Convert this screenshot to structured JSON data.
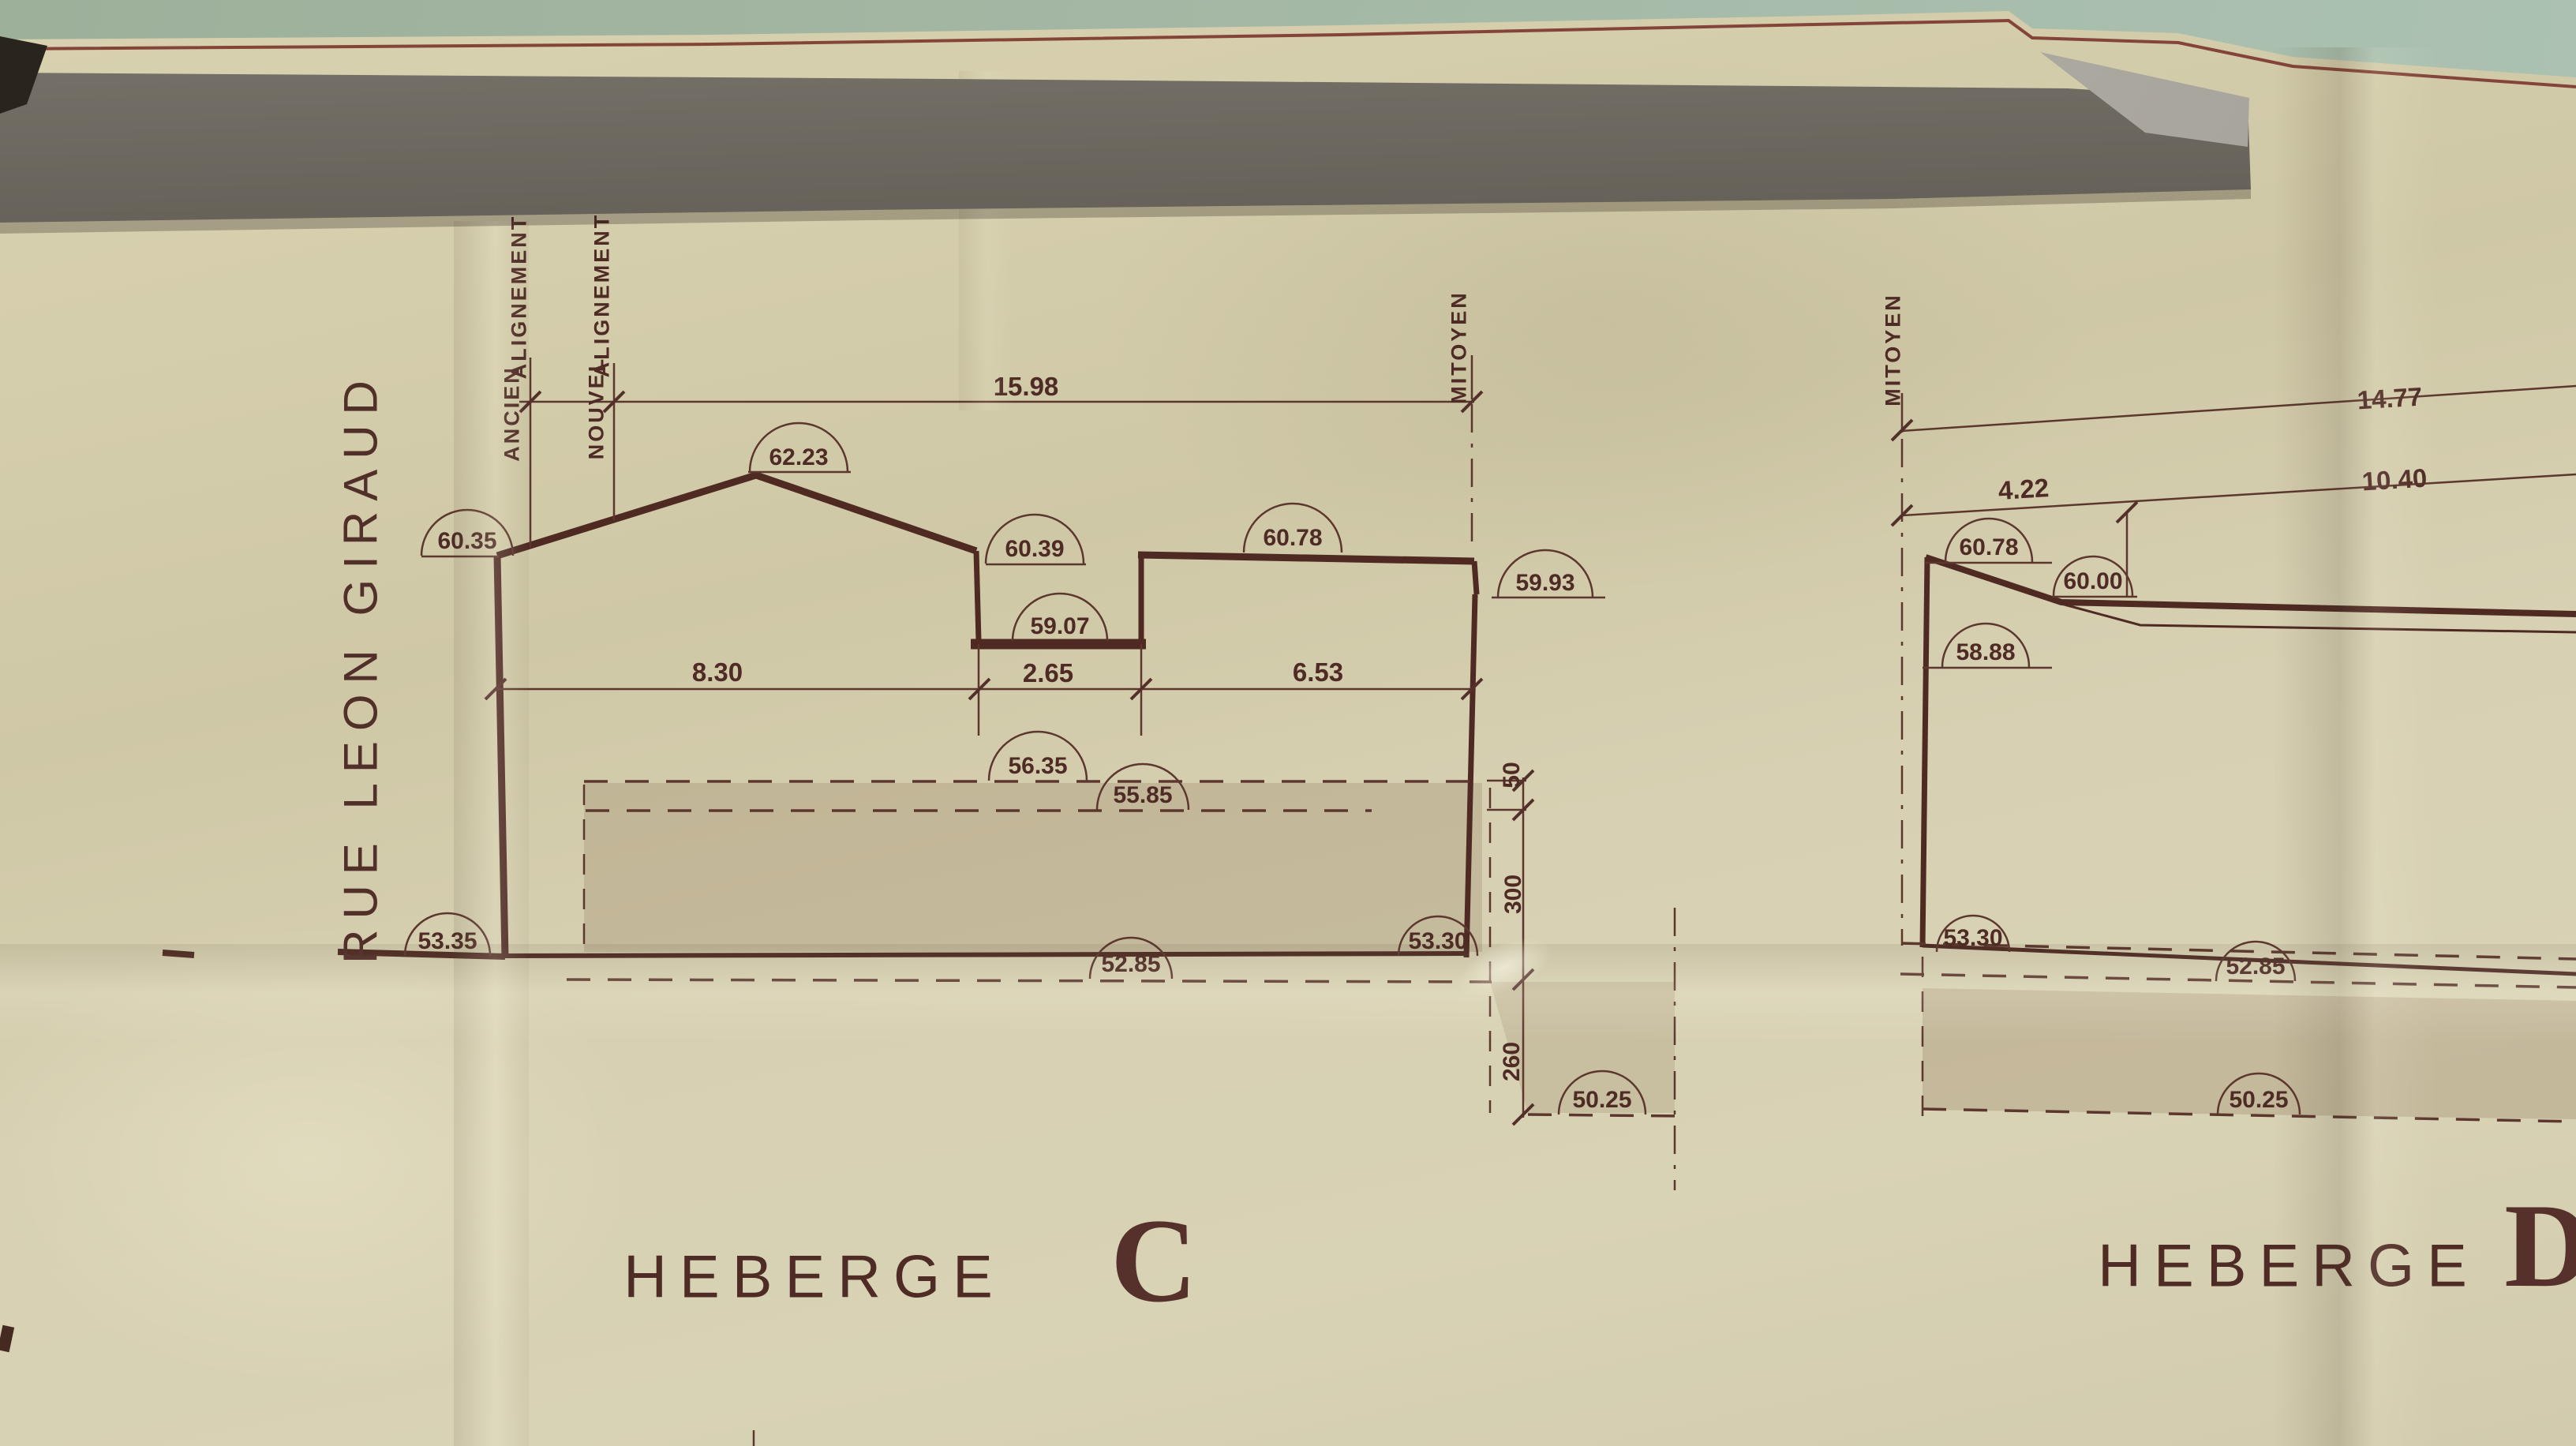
{
  "street": {
    "name": "RUE LEON GIRAUD"
  },
  "common": {
    "alignement": "ALIGNEMENT",
    "ancien": "ANCIEN",
    "nouvel": "NOUVEL",
    "mitoyen": "MITOYEN",
    "heberge": "HEBERGE"
  },
  "heberge_c": {
    "letter": "C",
    "dims": {
      "total": "15.98",
      "seg1": "8.30",
      "seg2": "2.65",
      "seg3": "6.53",
      "v_upper": "50",
      "v_mid": "300",
      "v_lower": "260"
    },
    "levels": {
      "street_wall_top": "60.35",
      "ridge": "62.23",
      "eave": "60.39",
      "recess_floor": "59.07",
      "flat_roof": "60.78",
      "party_wall_top": "59.93",
      "ground_upper": "56.35",
      "ground_lower": "55.85",
      "street_level": "53.35",
      "basement_line": "52.85",
      "party_ground": "53.30",
      "foundation": "50.25"
    }
  },
  "heberge_d": {
    "letter": "D",
    "dims": {
      "total": "14.77",
      "seg1": "4.22",
      "seg2": "10.40"
    },
    "levels": {
      "parapet": "60.78",
      "roof": "60.00",
      "wall_ledge": "58.88",
      "street_level": "53.30",
      "basement_line": "52.85",
      "foundation": "50.25"
    }
  },
  "colors": {
    "background": "#a5b8a6",
    "paper": "#d6cfb0",
    "ink": "#53302a",
    "tape_dark": "#524e46",
    "tape_light": "#8f8b84",
    "earth": "#8a6f52",
    "border_line": "#7b352c"
  }
}
